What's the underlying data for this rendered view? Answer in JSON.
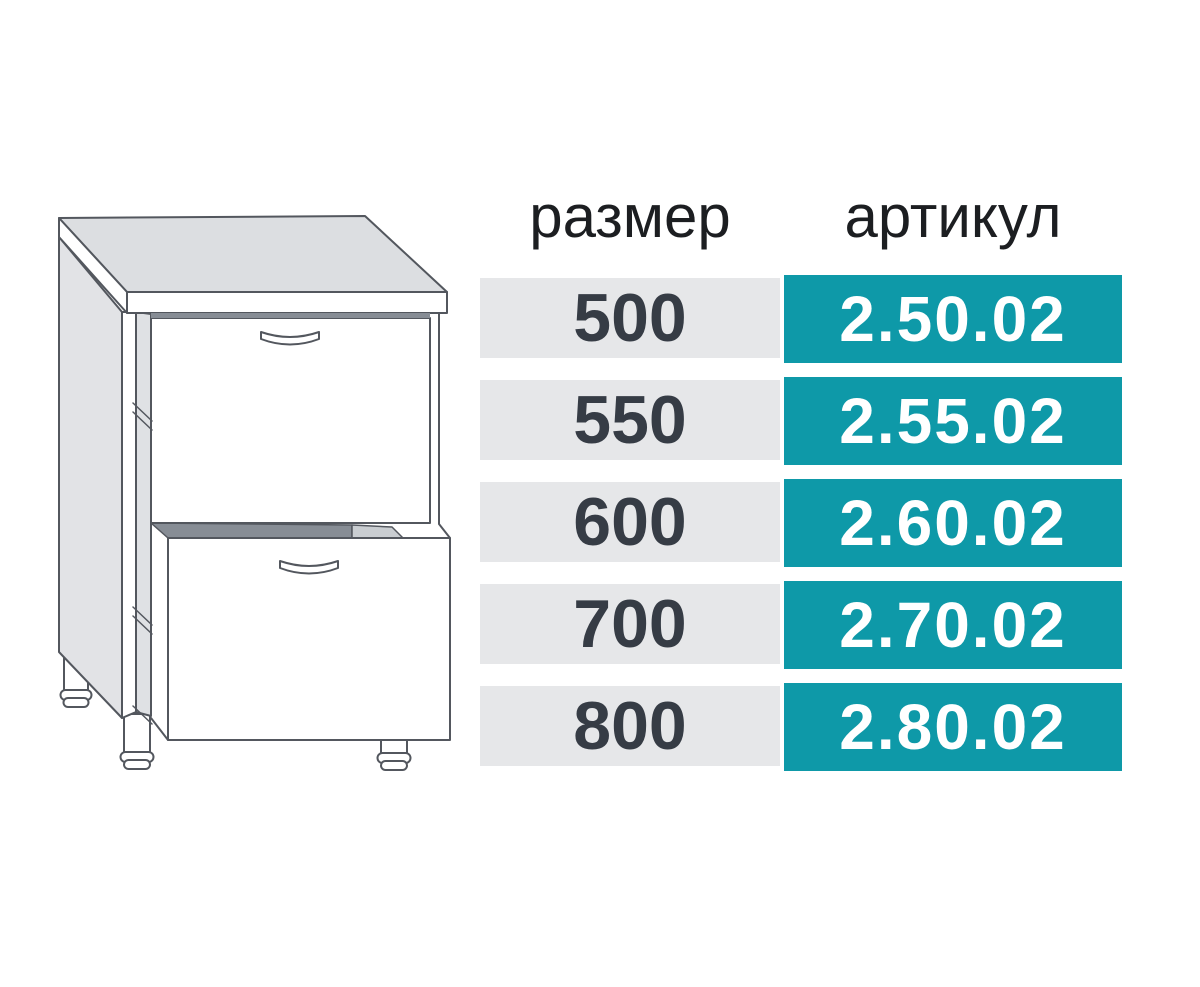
{
  "illustration": {
    "description": "line drawing of a base kitchen cabinet with countertop and two drawers on adjustable legs",
    "line_color": "#53575e",
    "counter_fill": "#dcdee1",
    "side_panel_fill": "#e2e3e6",
    "gap_shadow_fill": "#878d95"
  },
  "table": {
    "headers": {
      "size": "размер",
      "article": "артикул"
    },
    "rows": [
      {
        "size": "500",
        "article": "2.50.02"
      },
      {
        "size": "550",
        "article": "2.55.02"
      },
      {
        "size": "600",
        "article": "2.60.02"
      },
      {
        "size": "700",
        "article": "2.70.02"
      },
      {
        "size": "800",
        "article": "2.80.02"
      }
    ],
    "colors": {
      "accent_teal": "#0e99a8",
      "row_gray": "#e6e7e9",
      "size_text": "#363c45",
      "article_text": "#ffffff",
      "header_text": "#1c1e21"
    }
  }
}
